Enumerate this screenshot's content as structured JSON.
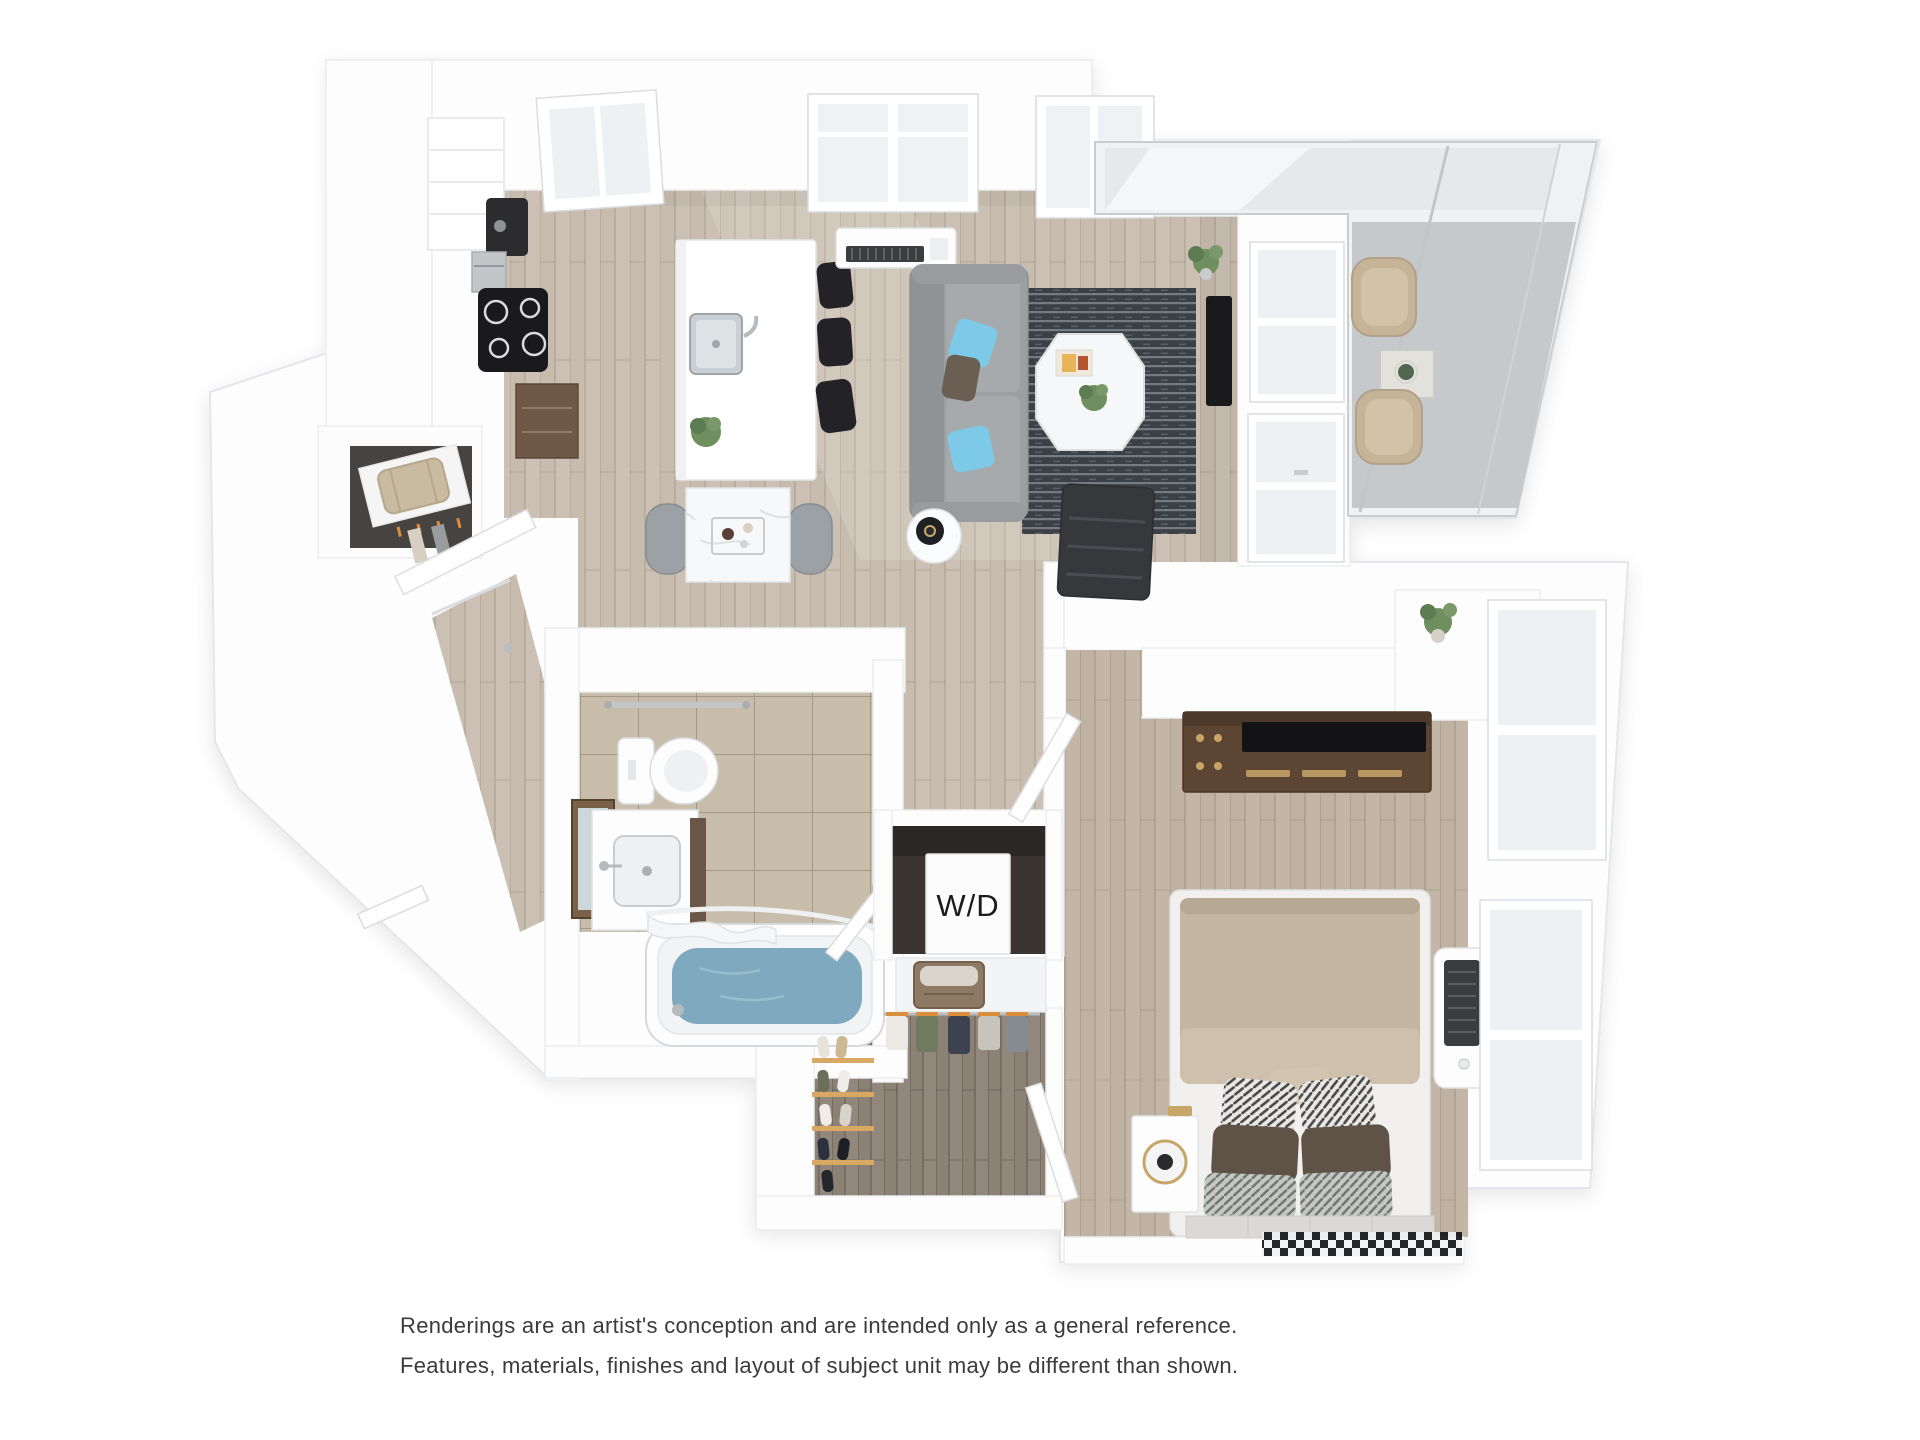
{
  "caption": {
    "line1": "Renderings are an artist's conception and are intended only as a general reference.",
    "line2": "Features, materials, finishes and layout of subject unit may be different than shown."
  },
  "labels": {
    "washer_dryer": "W/D"
  },
  "colors": {
    "floor_wood": "#c8bcae",
    "floor_wood_bedroom": "#c0b2a2",
    "floor_wood_closet": "#8c8175",
    "floor_tile": "#c8bdab",
    "floor_concrete": "#c5c9cb",
    "rug_dark": "#3b3f46",
    "rug_light": "#848990",
    "sofa": "#9da0a2",
    "pillow_blue": "#7dc9e8",
    "bed_duvet": "#c5b6a3",
    "dresser_wood": "#5c4533",
    "tub_water": "#7fa9be",
    "appliance_black": "#1a1a1d",
    "chair_tan": "#c6b499",
    "bag_tan": "#c9baa2"
  }
}
